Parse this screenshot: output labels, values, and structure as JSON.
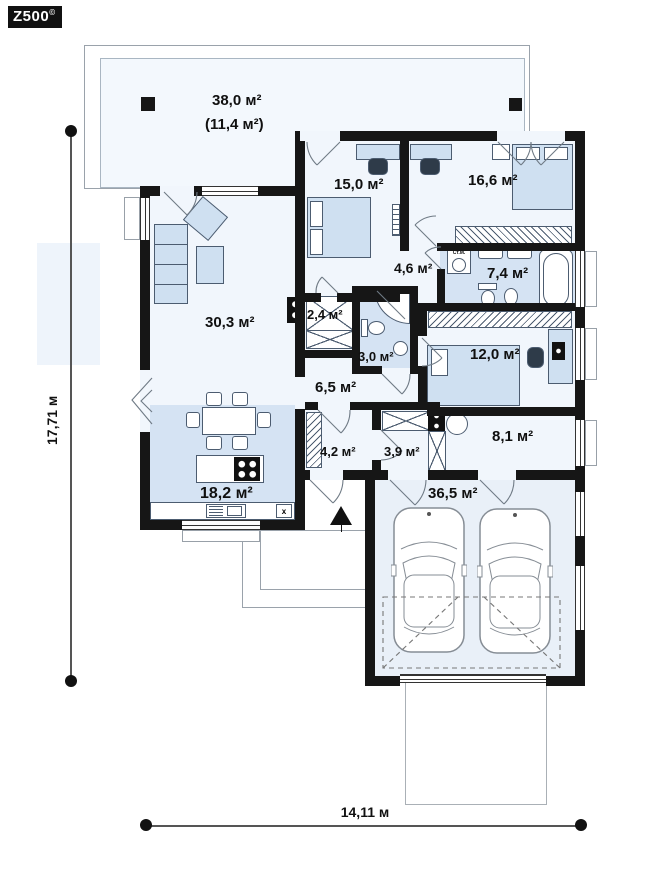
{
  "logo": {
    "brand": "Z500",
    "mark": "©"
  },
  "plan": {
    "terrace": {
      "area": "38,0 м²",
      "area_note": "(11,4 м²)"
    },
    "rooms": {
      "bedroom1": "15,0 м²",
      "bedroom2": "16,6 м²",
      "hall": "4,6 м²",
      "bathroom": "7,4 м²",
      "wardrobe": "2,4 м²",
      "wc": "3,0 м²",
      "living_room": "30,3 м²",
      "bedroom3": "12,0 м²",
      "hallway": "6,5 м²",
      "entry": "4,2 м²",
      "corridor": "3,9 м²",
      "utility": "8,1 м²",
      "kitchen": "18,2 м²",
      "garage": "36,5 м²"
    },
    "annotations": {
      "washing_machine": "Ст.М.",
      "counter_mark": "x"
    },
    "dimensions": {
      "height": "17,71 м",
      "width": "14,11 м"
    },
    "colors": {
      "wall": "#161616",
      "floor_light": "#f1f6fc",
      "floor_blue": "#d5e3f3",
      "furniture": "#cfe0f1",
      "terrace": "#f3f8fd"
    }
  }
}
